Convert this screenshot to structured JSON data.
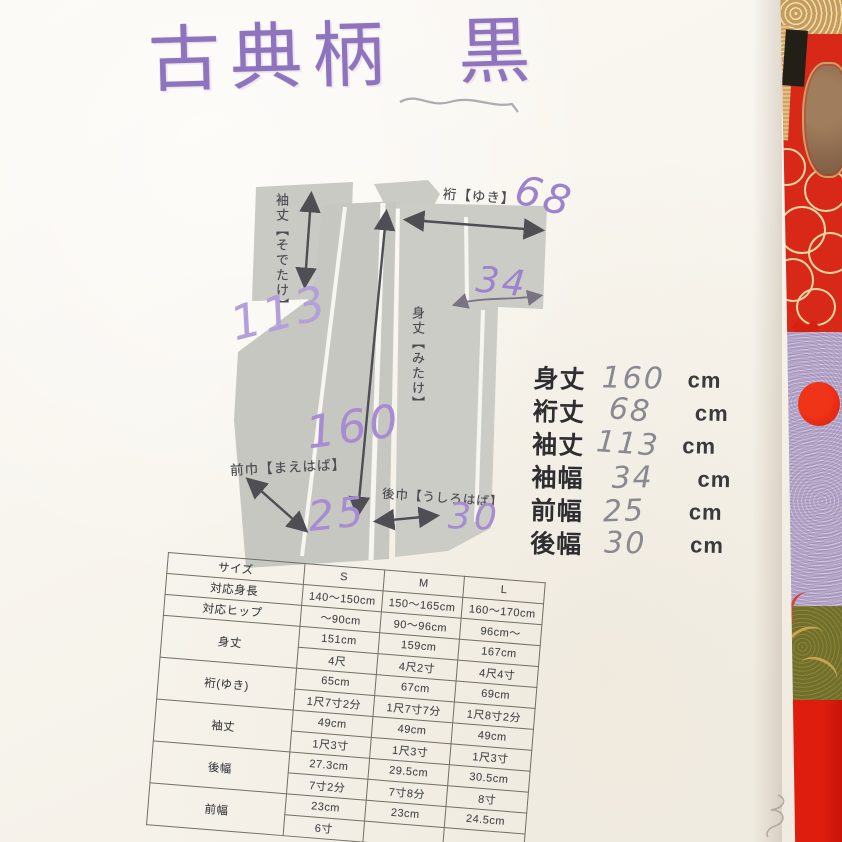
{
  "title": {
    "text": "古典柄 黒"
  },
  "diagram": {
    "label_sodetake": "袖丈【そでたけ】",
    "label_yuki": "裄【ゆき】",
    "label_mitake": "身丈【みたけ】",
    "label_maehaba": "前巾【まえはば】",
    "label_ushirohaba": "後巾【うしろはば】",
    "hw_sodetake": "113",
    "hw_yuki": "68",
    "hw_sodehaba": "34",
    "hw_mitake": "160",
    "hw_maehaba": "25",
    "hw_ushirohaba": "30"
  },
  "measurements": {
    "rows": [
      {
        "label": "身丈",
        "value": "160",
        "unit": "cm"
      },
      {
        "label": "裄丈",
        "value": "68",
        "unit": "cm"
      },
      {
        "label": "袖丈",
        "value": "113",
        "unit": "cm"
      },
      {
        "label": "袖幅",
        "value": "34",
        "unit": "cm"
      },
      {
        "label": "前幅",
        "value": "25",
        "unit": "cm"
      },
      {
        "label": "後幅",
        "value": "30",
        "unit": "cm"
      }
    ]
  },
  "size_table": {
    "header": {
      "size": "サイズ",
      "s": "S",
      "m": "M",
      "l": "L"
    },
    "height": {
      "label": "対応身長",
      "s": "140〜150cm",
      "m": "150〜165cm",
      "l": "160〜170cm"
    },
    "hip": {
      "label": "対応ヒップ",
      "s": "〜90cm",
      "m": "90〜96cm",
      "l": "96cm〜"
    },
    "mitake": {
      "label": "身丈",
      "s_cm": "151cm",
      "m_cm": "159cm",
      "l_cm": "167cm",
      "s_shaku": "4尺",
      "m_shaku": "4尺2寸",
      "l_shaku": "4尺4寸"
    },
    "yuki": {
      "label": "裄(ゆき)",
      "s_cm": "65cm",
      "m_cm": "67cm",
      "l_cm": "69cm",
      "s_shaku": "1尺7寸2分",
      "m_shaku": "1尺7寸7分",
      "l_shaku": "1尺8寸2分"
    },
    "sodetake": {
      "label": "袖丈",
      "s_cm": "49cm",
      "m_cm": "49cm",
      "l_cm": "49cm",
      "s_shaku": "1尺3寸",
      "m_shaku": "1尺3寸",
      "l_shaku": "1尺3寸"
    },
    "ushirohaba": {
      "label": "後幅",
      "s_cm": "27.3cm",
      "m_cm": "29.5cm",
      "l_cm": "30.5cm",
      "s_shaku": "7寸2分",
      "m_shaku": "7寸8分",
      "l_shaku": "8寸"
    },
    "maehaba": {
      "label": "前幅",
      "s_cm": "23cm",
      "m_cm": "23cm",
      "l_cm": "24.5cm",
      "s_shaku": "6寸"
    }
  },
  "colors": {
    "paper": "#f8f5ee",
    "diagram_gray": "#c8c9c3",
    "handwriting_purple": "#9d82cc",
    "pencil_gray": "#8a8992",
    "print_black": "#2e2e32",
    "fabric_red": "#d82817",
    "fabric_lavender": "#b5a7c9",
    "fabric_olive": "#70702c",
    "fabric_gold": "#c79b5c",
    "fabric_black": "#211f16"
  }
}
